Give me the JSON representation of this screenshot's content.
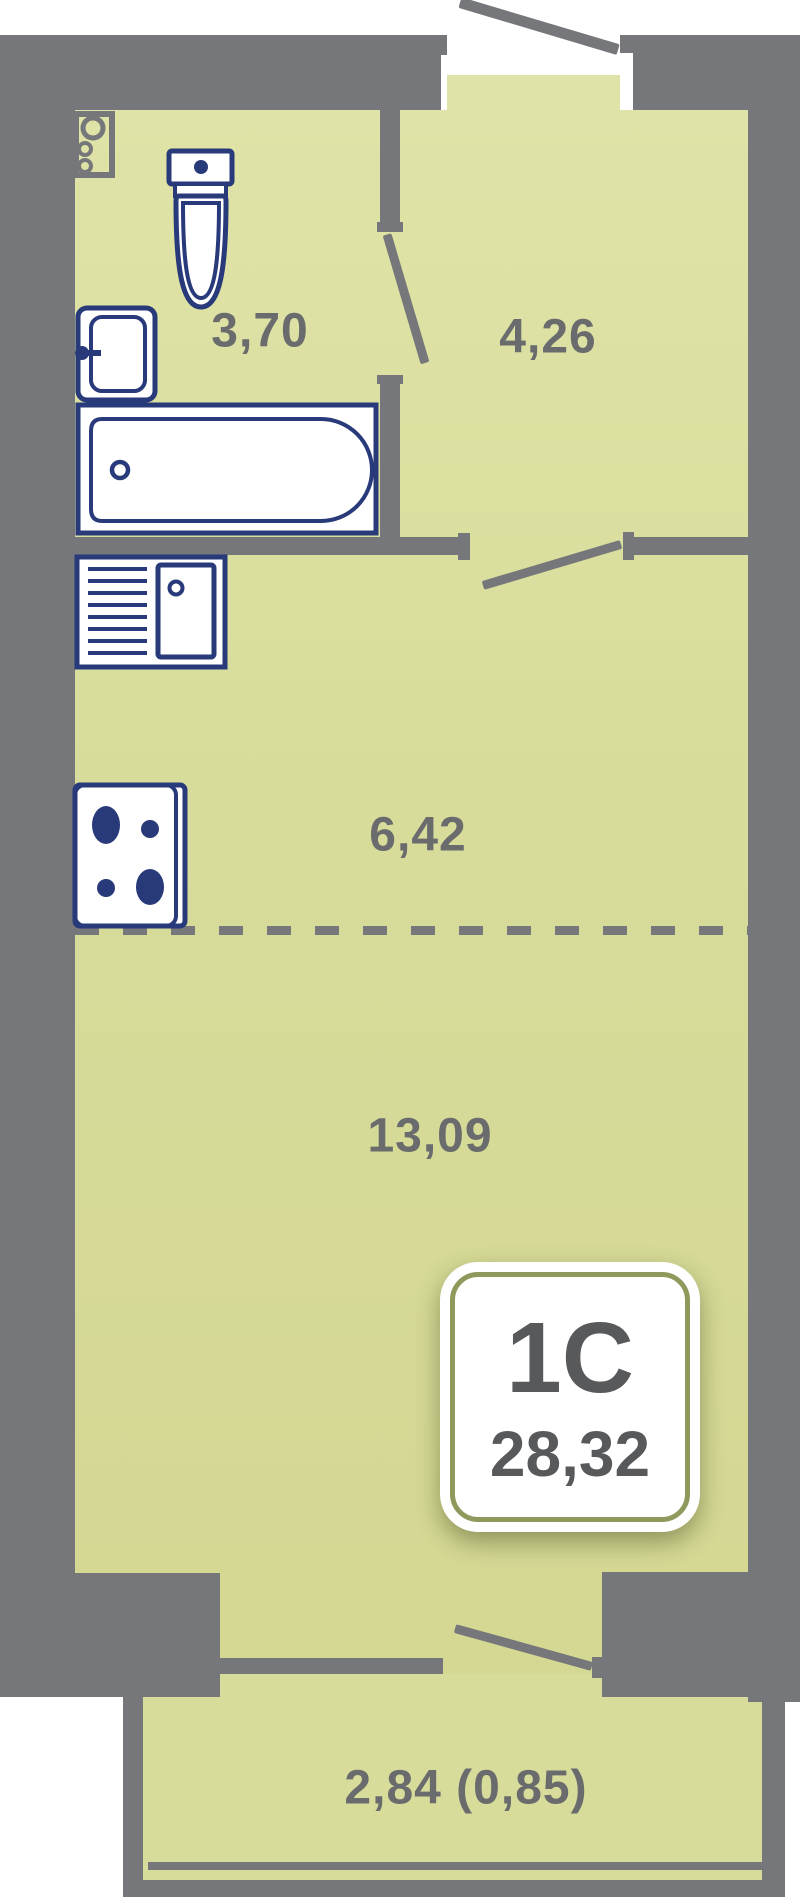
{
  "colors": {
    "floor": "#d8dc9b",
    "floor_light": "#dfe3a7",
    "floor_dark": "#d4d893",
    "wall": "#76777a",
    "fixture": "#283a7a",
    "label": "#6a6b6d",
    "badge_text": "#58595b",
    "badge_ring": "#8e9a5c"
  },
  "rooms": {
    "bathroom": {
      "area": "3,70"
    },
    "hallway": {
      "area": "4,26"
    },
    "kitchen": {
      "area": "6,42"
    },
    "living_room": {
      "area": "13,09"
    },
    "balcony": {
      "area": "2,84 (0,85)"
    }
  },
  "badge": {
    "type": "1С",
    "total_area": "28,32"
  },
  "fixtures": [
    "toilet",
    "wash-basin",
    "bathtub",
    "kitchen-sink",
    "stove",
    "utility-riser"
  ]
}
